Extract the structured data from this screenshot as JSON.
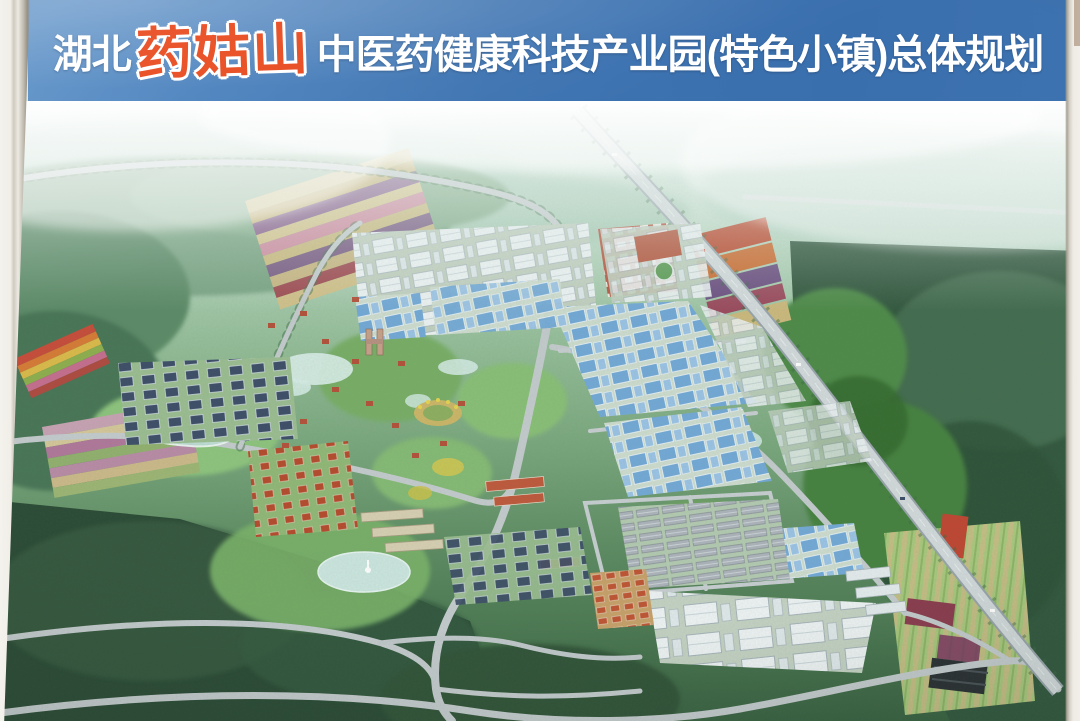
{
  "poster": {
    "banner": {
      "title_prefix": "湖北",
      "title_highlight": "药姑山",
      "title_suffix": "中医药健康科技产业园(特色小镇)总体规划",
      "full_title": "湖北药姑山中医药健康科技产业园(特色小镇)总体规划",
      "colors": {
        "background": "#3e74b2",
        "text": "#ffffff",
        "highlight": "#e8491d"
      }
    },
    "artwork": {
      "type": "aerial-masterplan-rendering",
      "features": [
        "hazy distant hills",
        "diagonal expressway",
        "blue-roof and white-roof factory blocks",
        "dark-roof apartment rows",
        "red-roof villa clusters",
        "striped farm fields and rainbow flower strips",
        "lakes and ponds with fountain",
        "central hilly park with amphitheater",
        "dense dark forest"
      ]
    }
  }
}
